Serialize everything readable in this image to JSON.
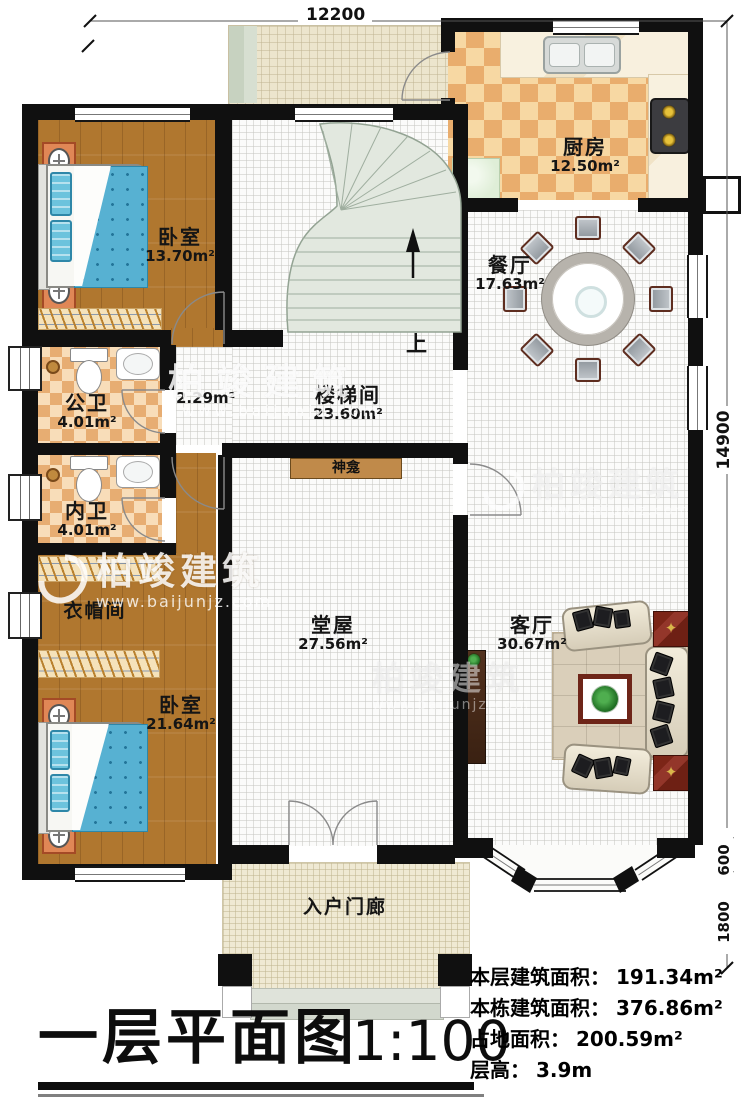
{
  "title": {
    "text": "一层平面图",
    "scale": "1:100"
  },
  "dimensions": {
    "top": "12200",
    "right": "14900",
    "right_lower": "600",
    "right_lowest": "1800"
  },
  "rooms": {
    "bedroom_top_left": {
      "name": "卧室",
      "area": "13.70m²"
    },
    "kitchen": {
      "name": "厨房",
      "area": "12.50m²"
    },
    "dining_room": {
      "name": "餐厅",
      "area": "17.63m²"
    },
    "stair_hall": {
      "name": "楼梯间",
      "area": "23.60m²"
    },
    "vestibule": {
      "area": "2.29m²"
    },
    "public_bathroom": {
      "name": "公卫",
      "area": "4.01m²"
    },
    "private_bathroom": {
      "name": "内卫",
      "area": "4.01m²"
    },
    "cloakroom": {
      "name": "衣帽间"
    },
    "bedroom_bottom_left": {
      "name": "卧室",
      "area": "21.64m²"
    },
    "main_hall": {
      "name": "堂屋",
      "area": "27.56m²"
    },
    "living_room": {
      "name": "客厅",
      "area": "30.67m²"
    },
    "entrance_porch": {
      "name": "入户门廊"
    },
    "shrine": {
      "name": "神龛"
    },
    "stair_direction": "上"
  },
  "stats": [
    {
      "label": "本层建筑面积：",
      "value": "191.34m²"
    },
    {
      "label": "本栋建筑面积：",
      "value": "376.86m²"
    },
    {
      "label": "占地面积：",
      "value": "200.59m²"
    },
    {
      "label": "层高：",
      "value": "3.9m"
    }
  ],
  "watermark": {
    "brand": "柏竣建筑",
    "url": "www.baijunjz.com"
  },
  "colors": {
    "wall": "#101010",
    "wood_floor": "#b0772f",
    "kitchen_checker": "#e9ad6d",
    "bed_blue": "#57b1d2",
    "accent_red": "#6e2014"
  }
}
